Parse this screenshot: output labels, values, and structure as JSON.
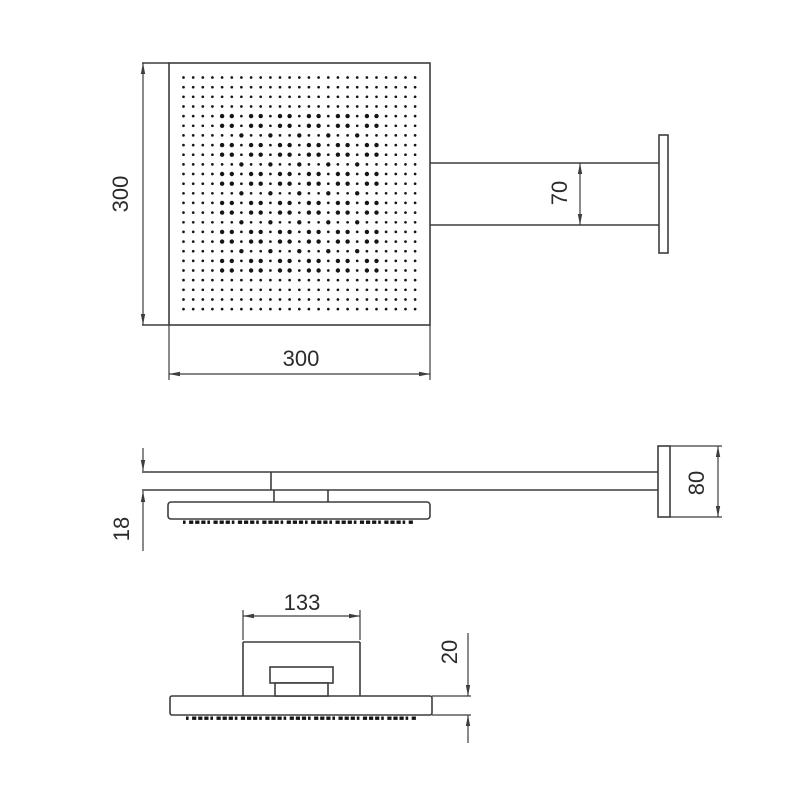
{
  "drawing": {
    "background": "#ffffff",
    "line_color": "#3d3d3d",
    "text_color": "#2b2b2b",
    "views": {
      "top_view": {
        "dim_height_label": "300",
        "dim_width_label": "300",
        "dim_arm_label": "70",
        "nozzle_grid": {
          "rows": 25,
          "cols": 25
        }
      },
      "side_view": {
        "dim_thickness_label": "18",
        "dim_wall_plate_label": "80"
      },
      "front_view": {
        "dim_bracket_label": "133",
        "dim_edge_label": "20"
      }
    }
  }
}
